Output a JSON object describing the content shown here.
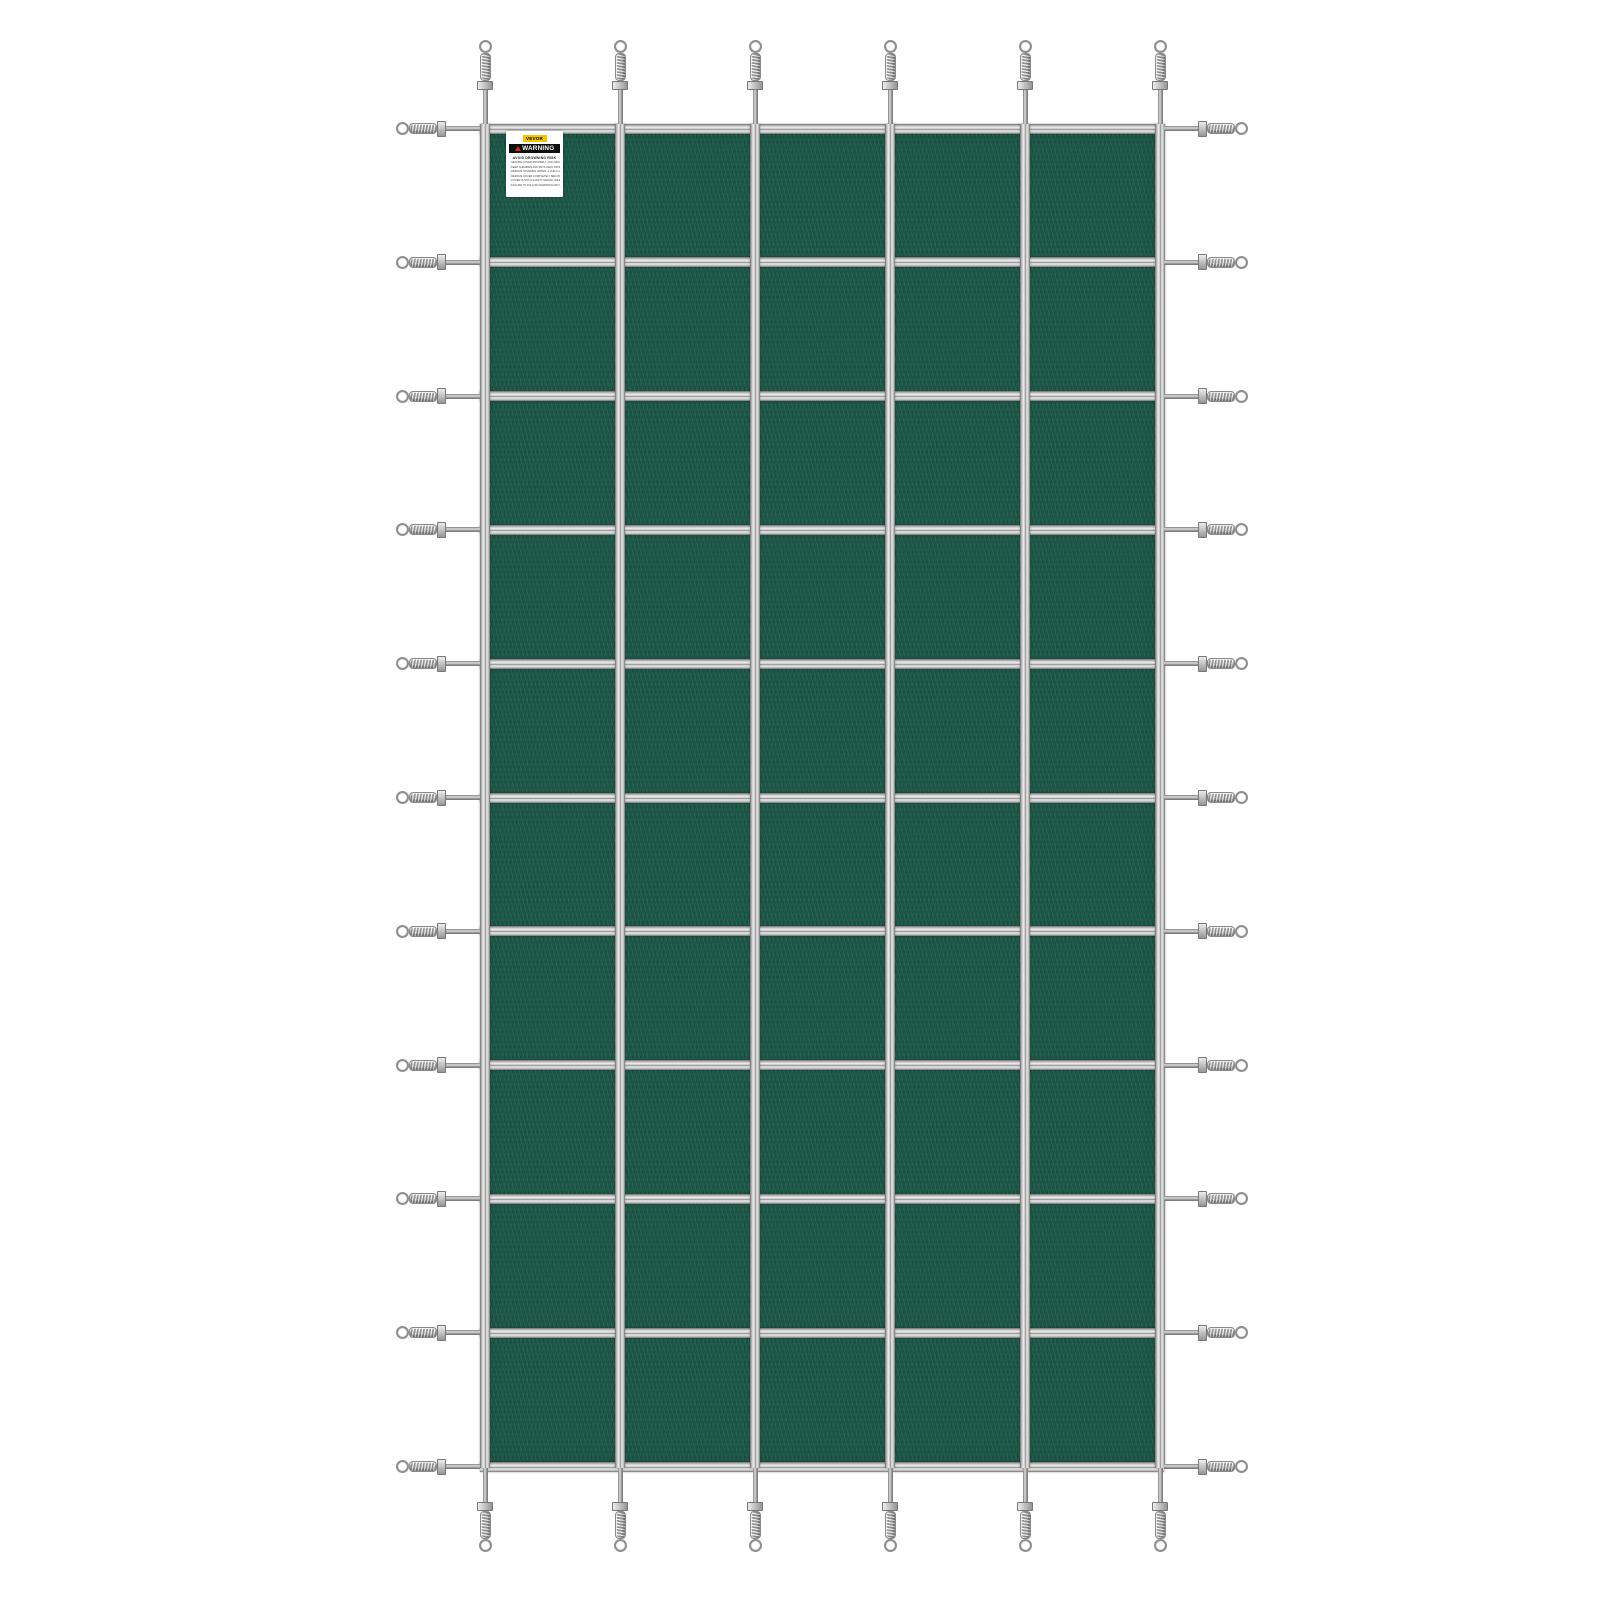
{
  "image": {
    "type": "product-photo",
    "subject": "Rectangular inground pool safety cover with strap grid and spring anchors",
    "background_color": "#ffffff"
  },
  "cover": {
    "mesh_color": "#1e5a4b",
    "strap_color": "#c7c7c7",
    "grid": {
      "vertical_straps": 6,
      "horizontal_straps": 11,
      "columns": 5,
      "rows": 10
    },
    "anchors": {
      "top": 6,
      "bottom": 6,
      "left": 11,
      "right": 11,
      "total": 34,
      "type": "coil spring with ring end"
    }
  },
  "label": {
    "brand": "VEVOR",
    "warning_title": "WARNING",
    "warning_subtitle": "AVOID DROWNING RISK",
    "warning_lines": [
      "SECURE COVER PROPERLY. NON-SECURED OR IMPROPERLY SECURED COVERS ARE A HAZARD.",
      "KEEP CHILDREN AND PETS AWAY FROM POOL WHEN COVER IS IN PLACE.",
      "REMOVE STANDING WATER. A CHILD CAN DROWN ON TOP OF THE COVER.",
      "REMOVE COVER COMPLETELY BEFORE ENTRY OF BATHERS.",
      "COVER IS NOT A SAFETY DEVICE UNLESS FULLY ANCHORED.",
      "FAILURE TO FOLLOW WARNINGS MAY RESULT IN SERIOUS INJURY OR DROWNING."
    ]
  }
}
